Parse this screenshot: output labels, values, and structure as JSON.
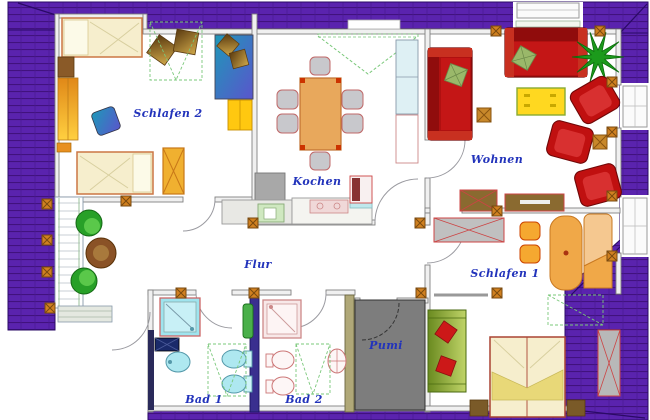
{
  "drawing": {
    "type": "floor-plan",
    "style": "CAD top view of an attic apartment with purple tiled roof border",
    "language": "German"
  },
  "rooms": [
    {
      "name": "Schlafen 2",
      "type": "bedroom-2"
    },
    {
      "name": "Kochen",
      "type": "kitchen"
    },
    {
      "name": "Wohnen",
      "type": "living-room"
    },
    {
      "name": "Flur",
      "type": "hallway"
    },
    {
      "name": "Schlafen 1",
      "type": "bedroom-1"
    },
    {
      "name": "Bad 1",
      "type": "bathroom-1"
    },
    {
      "name": "Bad 2",
      "type": "bathroom-2"
    },
    {
      "name": "Pumi",
      "type": "storage-room"
    }
  ],
  "furniture": {
    "schlafen2": [
      "single bed",
      "second single bed",
      "wardrobe",
      "yellow closet",
      "blue desk",
      "desk chairs",
      "nightstand"
    ],
    "kochen": [
      "dining table",
      "six chairs",
      "counter with sink",
      "stove",
      "cooktop",
      "tall fridge cabinet"
    ],
    "wohnen": [
      "red sofa top",
      "red sofa left",
      "three red armchairs",
      "yellow coffee table",
      "potted plant",
      "sideboard",
      "lowboard",
      "side tables"
    ],
    "flur": [
      "two green chairs",
      "round wooden table"
    ],
    "schlafen1": [
      "double bed",
      "two nightstands",
      "green sofa with red pillows",
      "desk",
      "two chairs",
      "lounge chair",
      "gray wardrobe",
      "eaves wardrobe"
    ],
    "bad1": [
      "shower",
      "washbasin",
      "toilet",
      "bidet",
      "dark cabinet"
    ],
    "bad2": [
      "shower",
      "washbasin",
      "toilet",
      "bidet",
      "green cabinet"
    ],
    "pumi": []
  },
  "colors": {
    "roof": "#5a23ae",
    "roof_line": "#41127e",
    "label_text": "#2233bb",
    "wall_fill": "#f0f0f0",
    "wall_stroke": "#808080",
    "sofa_red": "#b01010",
    "armchair_red": "#c01010",
    "plant_green": "#1c9a1c",
    "coffee_table_yellow": "#ffd820",
    "wood_brown": "#8a6a30",
    "bed_cream": "#f6eecd",
    "bath_cyan": "#aee8f0",
    "bath_pink": "#cc8888",
    "storage_gray": "#7d7d7d",
    "post_orange": "#d08020",
    "planned_dashed_green": "#7ac87a"
  }
}
